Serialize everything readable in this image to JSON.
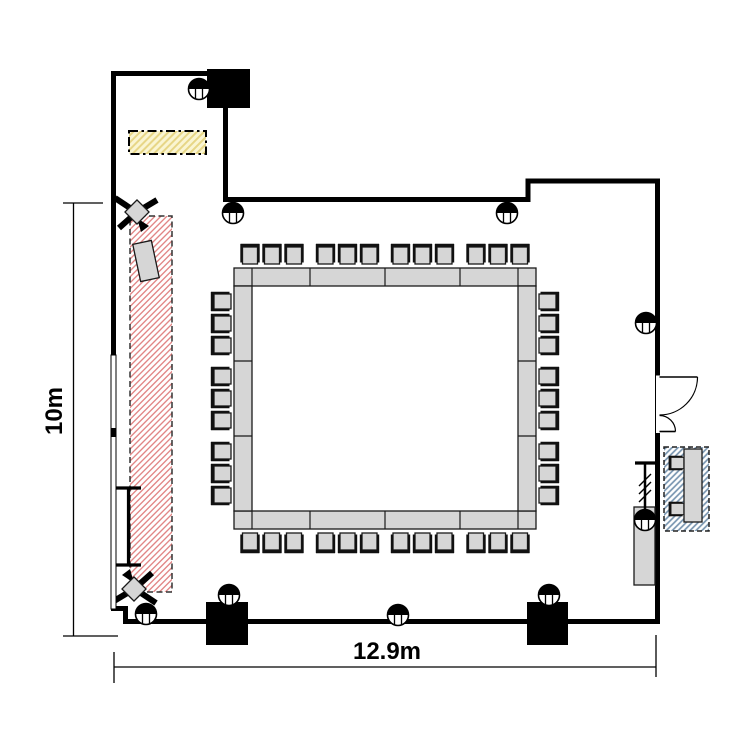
{
  "plan": {
    "dimensions": {
      "width_label": "12.9m",
      "height_label": "10m"
    },
    "colors": {
      "wall": "#000000",
      "furniture_fill": "#d6d6d6",
      "furniture_stroke": "#1a1a1a",
      "stage_hatch": "#e08080",
      "storage_hatch": "#e7d686",
      "storage_fill": "#faf5d2",
      "av_hatch": "#7895b0"
    },
    "walls": {
      "thickness": 5,
      "segments": [
        "M113.5,357 L113.5,73.5 L250,73.5",
        "M225.5,103 L225.5,199.5 L528,199.5 L528,181 L657.5,181 L657.5,377",
        "M657.5,430 L657.5,621.5 L125.5,621.5 L125.5,608.5 L111,608.5"
      ]
    },
    "window_wall": {
      "x": 111,
      "y": 355,
      "w": 5,
      "h": 254,
      "marker_y": 428,
      "marker_h": 9
    },
    "pillars": [
      {
        "x": 207,
        "y": 69,
        "w": 43,
        "h": 39
      },
      {
        "x": 206,
        "y": 602,
        "w": 42,
        "h": 43
      },
      {
        "x": 527,
        "y": 602,
        "w": 41,
        "h": 43
      }
    ],
    "floor_boxes": [
      {
        "cx": 199,
        "cy": 89
      },
      {
        "cx": 233,
        "cy": 213
      },
      {
        "cx": 507,
        "cy": 213
      },
      {
        "cx": 646,
        "cy": 323
      },
      {
        "cx": 645,
        "cy": 520
      },
      {
        "cx": 146,
        "cy": 614
      },
      {
        "cx": 229,
        "cy": 595
      },
      {
        "cx": 398,
        "cy": 615
      },
      {
        "cx": 549,
        "cy": 595
      }
    ],
    "stage_area": {
      "x": 130,
      "y": 216,
      "w": 42,
      "h": 376
    },
    "storage_area": {
      "x": 129,
      "y": 131,
      "w": 77,
      "h": 23
    },
    "av_area": {
      "x": 664,
      "y": 447,
      "w": 45,
      "h": 84
    },
    "av_desk": {
      "x": 684,
      "y": 449,
      "w": 18,
      "h": 73
    },
    "av_chairs": [
      {
        "cx": 677,
        "cy": 463
      },
      {
        "cx": 677,
        "cy": 509
      }
    ],
    "lectern": {
      "cx": 146,
      "cy": 261,
      "w": 19,
      "h": 38,
      "angle": -12
    },
    "speakers": [
      {
        "cx": 137,
        "cy": 212,
        "angle": 0
      },
      {
        "cx": 134,
        "cy": 589,
        "angle": 180
      }
    ],
    "screen": {
      "x1": 116,
      "x2": 141,
      "y1": 488,
      "y2": 565
    },
    "flipchart": {
      "x1": 635,
      "x2": 655,
      "y": 463,
      "stem_bottom": 516,
      "slashes": 3
    },
    "cabinet": {
      "x": 634,
      "y": 507,
      "w": 21,
      "h": 78
    },
    "door": {
      "wall_x": 657.5,
      "top": 377,
      "bottom": 431.5,
      "leaf_long": 38,
      "leaf_short": 16
    },
    "table": {
      "type": "hollow-square",
      "x": 234,
      "y": 268,
      "w": 302,
      "h": 261,
      "band": 18,
      "top_divisions": [
        252,
        310,
        385,
        460,
        518
      ],
      "side_divisions": [
        361,
        436
      ],
      "seats": {
        "top": 12,
        "right": 9,
        "bottom": 12,
        "left": 9,
        "total": 42
      },
      "chair_pitch": 22,
      "top_group_centers": [
        272,
        347.5,
        422.5,
        498
      ],
      "side_group_centers": [
        323.5,
        398.5,
        473.5
      ],
      "top_row_cy": 255,
      "bottom_row_cy": 542,
      "left_col_cx": 222,
      "right_col_cx": 548
    },
    "dim_h": {
      "y": 667,
      "x1": 114,
      "x2": 656
    },
    "dim_v": {
      "x": 73.5,
      "y1": 203,
      "y2": 636
    }
  }
}
